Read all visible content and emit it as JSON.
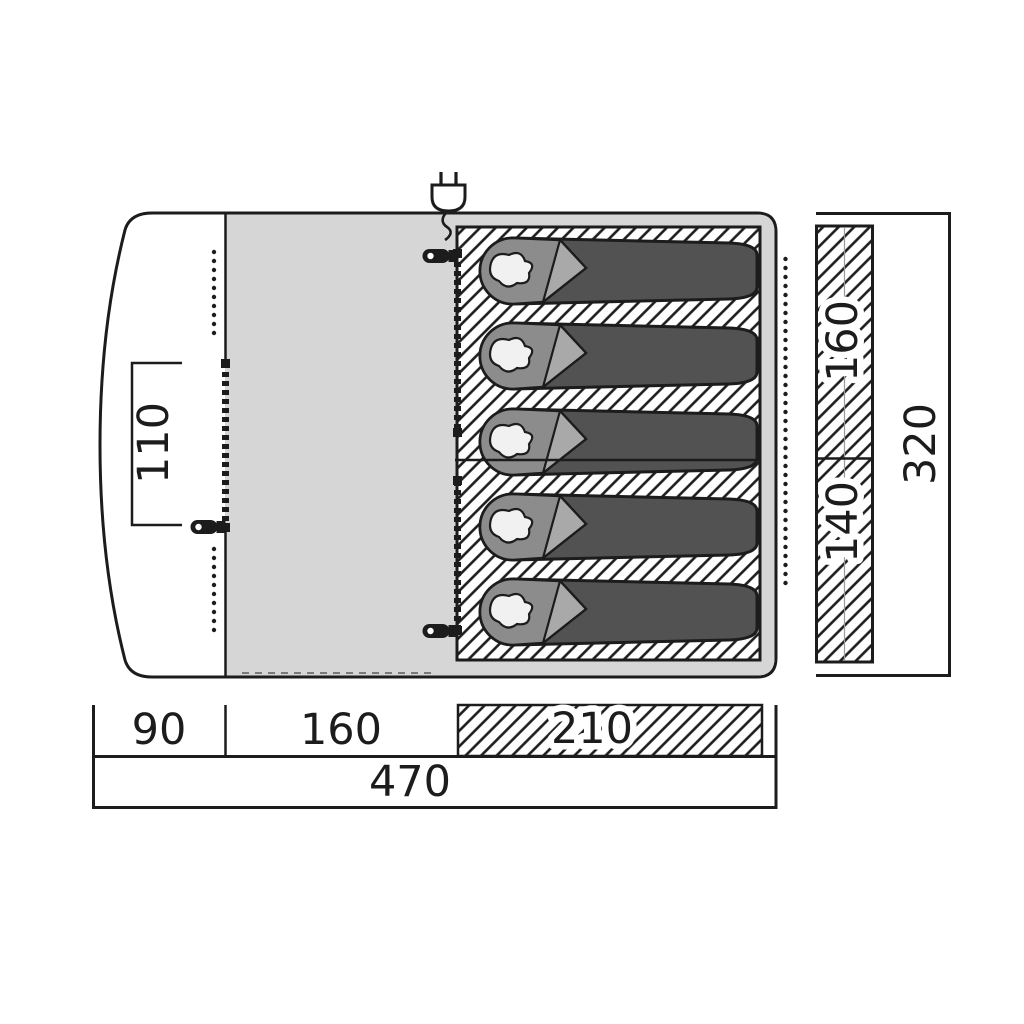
{
  "title": "Tent floor plan diagram",
  "dimensions": {
    "door_width": "110",
    "bedroom_width_a": "160",
    "bedroom_width_b": "140",
    "total_width": "320",
    "porch_depth": "90",
    "living_depth": "160",
    "bedroom_depth": "210",
    "total_length": "470"
  },
  "icons": {
    "power_plug": "power-plug-icon",
    "zipper_pull": "zipper-pull-icon"
  },
  "sleeping_bag_count": 5,
  "colors": {
    "outline": "#1c1c1c",
    "living_area": "#d6d6d6",
    "bag_body": "#525252",
    "bag_hood": "#8c8c8c",
    "bag_fold": "#a9a9a9",
    "pillow": "#f1f1f1"
  }
}
